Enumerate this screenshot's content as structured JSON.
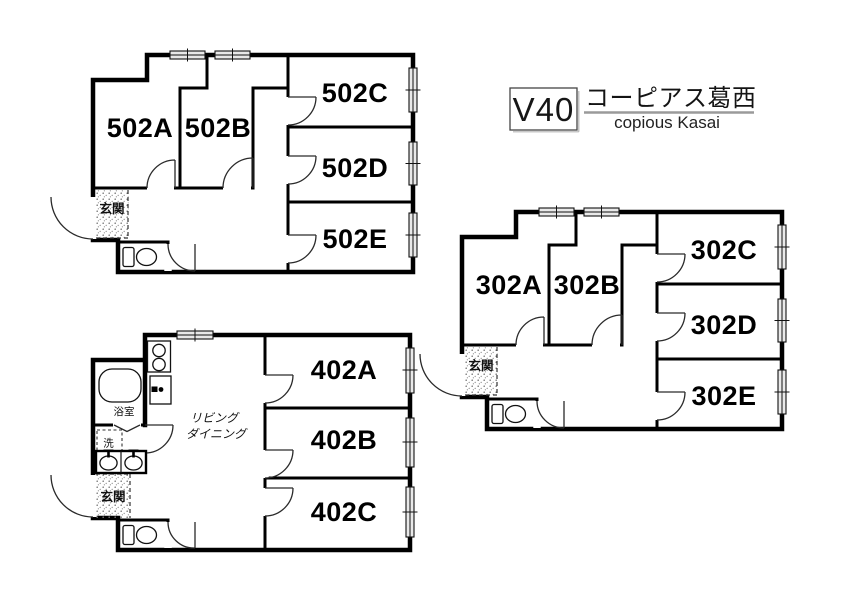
{
  "title_block": {
    "code": "V40",
    "building_name_ja": "コーピアス葛西",
    "building_name_en": "copious Kasai"
  },
  "plans": [
    {
      "name": "5F unit",
      "rooms": [
        "502A",
        "502B",
        "502C",
        "502D",
        "502E"
      ],
      "entrance_label": "玄関"
    },
    {
      "name": "4F unit",
      "rooms": [
        "402A",
        "402B",
        "402C"
      ],
      "living_label": [
        "リビング",
        "ダイニング"
      ],
      "bath_label": "浴室",
      "laundry_label": "洗",
      "entrance_label": "玄関"
    },
    {
      "name": "3F unit",
      "rooms": [
        "302A",
        "302B",
        "302C",
        "302D",
        "302E"
      ],
      "entrance_label": "玄関"
    }
  ],
  "colors": {
    "wall": "#000000",
    "background": "#ffffff",
    "window_fill": "#e9e9e9",
    "title_underline": "#9a9a9a"
  }
}
